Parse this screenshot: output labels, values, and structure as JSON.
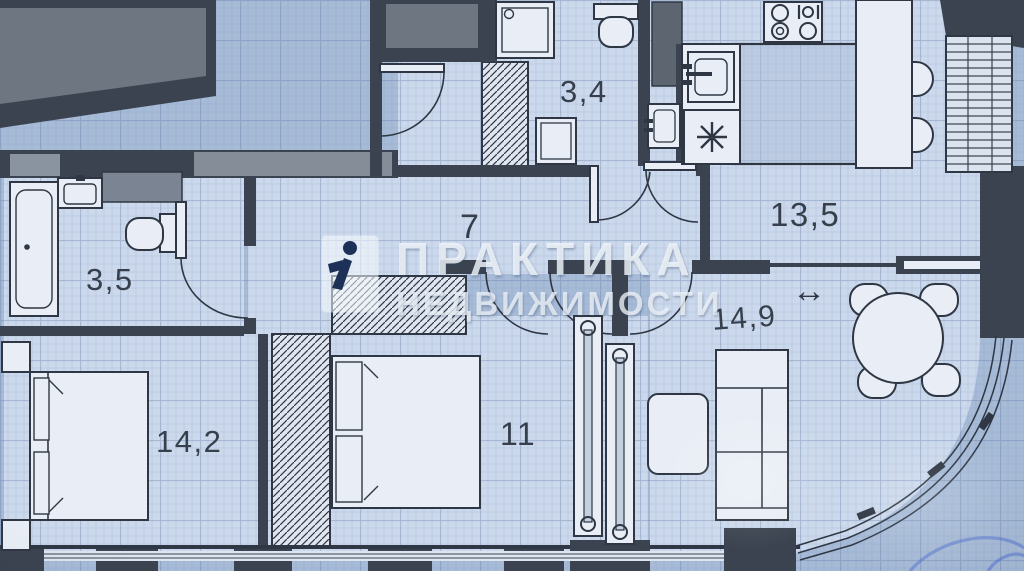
{
  "watermark": {
    "line1": "ПРАКТИКА",
    "line2": "НЕДВИЖИМОСТИ",
    "logo": "praktika-nedvizhimosti-logo"
  },
  "rooms": [
    {
      "name": "bathroom",
      "area_m2": "3,5"
    },
    {
      "name": "bathroom-2",
      "area_m2": "3,4"
    },
    {
      "name": "hallway",
      "area_m2": "7"
    },
    {
      "name": "kitchen-dining",
      "area_m2": "13,5"
    },
    {
      "name": "living-room",
      "area_m2": "14,9"
    },
    {
      "name": "bedroom",
      "area_m2": "14,2"
    },
    {
      "name": "bedroom-2",
      "area_m2": "11"
    }
  ],
  "symbols": {
    "sliding_door_arrow": "↔",
    "fridge_snowflake": "✳"
  },
  "colors": {
    "paper": "#a7bbd7",
    "room_floor": "#ccd9ec",
    "wall": "#3a434f",
    "line": "#2e3743",
    "fixture": "#e9eef6",
    "gray_insert": "#808997",
    "watermark_text": "#f2f6fb"
  }
}
